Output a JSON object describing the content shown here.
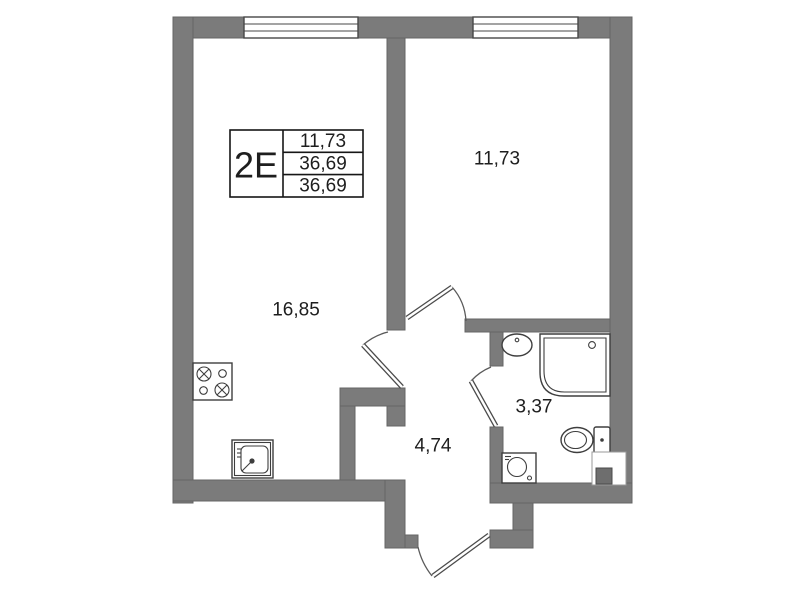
{
  "plan": {
    "title": "apartment-floor-plan",
    "unit_label": "2E",
    "info_box": {
      "rows": [
        "11,73",
        "36,69",
        "36,69"
      ]
    },
    "rooms": [
      {
        "name": "bedroom",
        "area": "11,73"
      },
      {
        "name": "living-kitchen",
        "area": "16,85"
      },
      {
        "name": "hallway",
        "area": "4,74"
      },
      {
        "name": "bathroom",
        "area": "3,37"
      }
    ],
    "fixtures": [
      "stove-icon",
      "kitchen-sink-icon",
      "washbasin-icon",
      "shower-icon",
      "toilet-icon",
      "washing-machine-icon",
      "vent-shaft-icon"
    ],
    "windows": 2,
    "doors": 4,
    "colors": {
      "wall": "#7b7b7b",
      "wall_stroke": "#646464",
      "text": "#1e1e1e",
      "background": "#ffffff"
    }
  }
}
